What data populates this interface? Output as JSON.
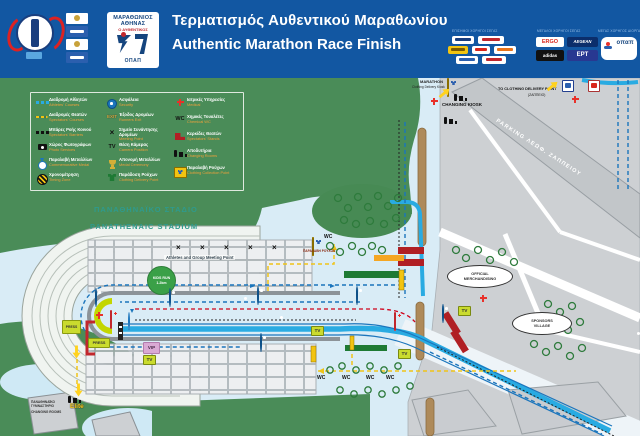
{
  "header": {
    "title_el": "Τερματισμός Αυθεντικού Μαραθωνίου",
    "title_en": "Authentic Marathon Race Finish",
    "marathon_logo": {
      "line1": "ΜΑΡΑΘΩΝΙΟΣ ΑΘΗΝΑΣ",
      "line2": "Ο ΑΥΘΕΝΤΙΚΟΣ",
      "brand": "ΟΠΑΠ"
    },
    "sponsors": {
      "group1_caption": "ΕΠΙΣΗΜΟΙ ΧΟΡΗΓΟΙ ΣΕΓΑΣ",
      "group2_caption": "ΜΕΓΑΛΟΙ ΧΟΡΗΓΟΙ ΣΕΓΑΣ",
      "group3_caption": "ΜΕΓΑΣ ΧΟΡΗΓΟΣ ΔΙΟΡΓΑΝΩΣΗΣ",
      "group2_logos": [
        "ERGO",
        "AEGEAN",
        "adidas",
        "ΕΡΤ"
      ],
      "group3_logo": "οπαπ"
    }
  },
  "legend": {
    "items": [
      {
        "el": "Διαδρομή Αθλητών",
        "en": "Athletes' Courses"
      },
      {
        "el": "Διαδρομές Θεατών",
        "en": "Spectators' Courses"
      },
      {
        "el": "Μπάρες Ροής Κοινού",
        "en": "Spectators' Barriers"
      },
      {
        "el": "Χώρος Φωτογράφων",
        "en": "Photo Services"
      },
      {
        "el": "Παραλαβή Μεταλλίων",
        "en": "Commemorative Medal"
      },
      {
        "el": "Χρονομέτρηση",
        "en": "Timing Zone"
      },
      {
        "el": "Ασφάλεια",
        "en": "Security"
      },
      {
        "el": "Έξοδος Δρομέων",
        "en": "Runners Exit",
        "icon_text": "EXIT"
      },
      {
        "el": "Σημείο Συνάντησης Δρομέων",
        "en": "Meeting Point"
      },
      {
        "el": "Θέση Κάμερας",
        "en": "Camera Position",
        "icon_text": "TV"
      },
      {
        "el": "Απονομή Μεταλλίων",
        "en": "Medal Ceremony"
      },
      {
        "el": "Παράδοση Ρούχων",
        "en": "Clothing Delivery Point"
      },
      {
        "el": "Ιατρικές Υπηρεσίες",
        "en": "Medical"
      },
      {
        "el": "Χημικές Τουαλέτες",
        "en": "Chemical WC",
        "icon_text": "WC"
      },
      {
        "el": "Κερκίδες Θεατών",
        "en": "Spectators' Stands"
      },
      {
        "el": "Αποδυτήρια",
        "en": "Changing Rooms"
      },
      {
        "el": "Παραλαβή Ρούχων",
        "en": "Clothing Collection Point"
      }
    ]
  },
  "map": {
    "labels": {
      "stadium_el": "ΠΑΝΑΘΗΝΑΪΚΟ ΣΤΑΔΙΟ",
      "stadium_en": "PANATHENAIC STADIUM",
      "meeting_point": "Athletes and Group Meeting Point",
      "kids_run_1": "KIDS RUN",
      "kids_run_2": "1.2km",
      "parking": "PARKING ΛΕΩΦ. ΖΑΠΠΕΙΟΥ",
      "official_merch_1": "OFFICIAL",
      "official_merch_2": "MERCHANDISING",
      "sponsors_village_1": "SPONSORS",
      "sponsors_village_2": "VILLAGE",
      "changing_kiosk_1": "CHANGING",
      "changing_kiosk_2": "KIOSK",
      "marathon_kiosk_1": "MARATHON",
      "marathon_kiosk_2": "Clothing Delivery Kiosk",
      "to_clothing_1": "TO CLOTHING DELIVERY POINT",
      "to_clothing_2": "(ΖΑΠΠΕΙΟ)",
      "elite": "Elite",
      "gym_el": "ΠΑΝΑΘΗΝΑΪΚΟ ΓΥΜΝΑΣΤΗΡΙΟ",
      "gym_en": "CHANGING ROOMS",
      "press": "PRESS",
      "vip": "VIP",
      "tv": "TV",
      "wc": "WC",
      "clothes_pickup": "ΠΑΡΑΛΑΒΗ ΡΟΥΧΩΝ"
    },
    "colors": {
      "header_blue": "#1257a2",
      "park_green": "#4a8c58",
      "course_cyan": "#29abe2",
      "route_blue": "#1b75bc",
      "spectator_yellow": "#f2c411",
      "medical_red": "#e8312a",
      "stand_red": "#b01f24",
      "street_gray": "#cdd0d3"
    }
  }
}
